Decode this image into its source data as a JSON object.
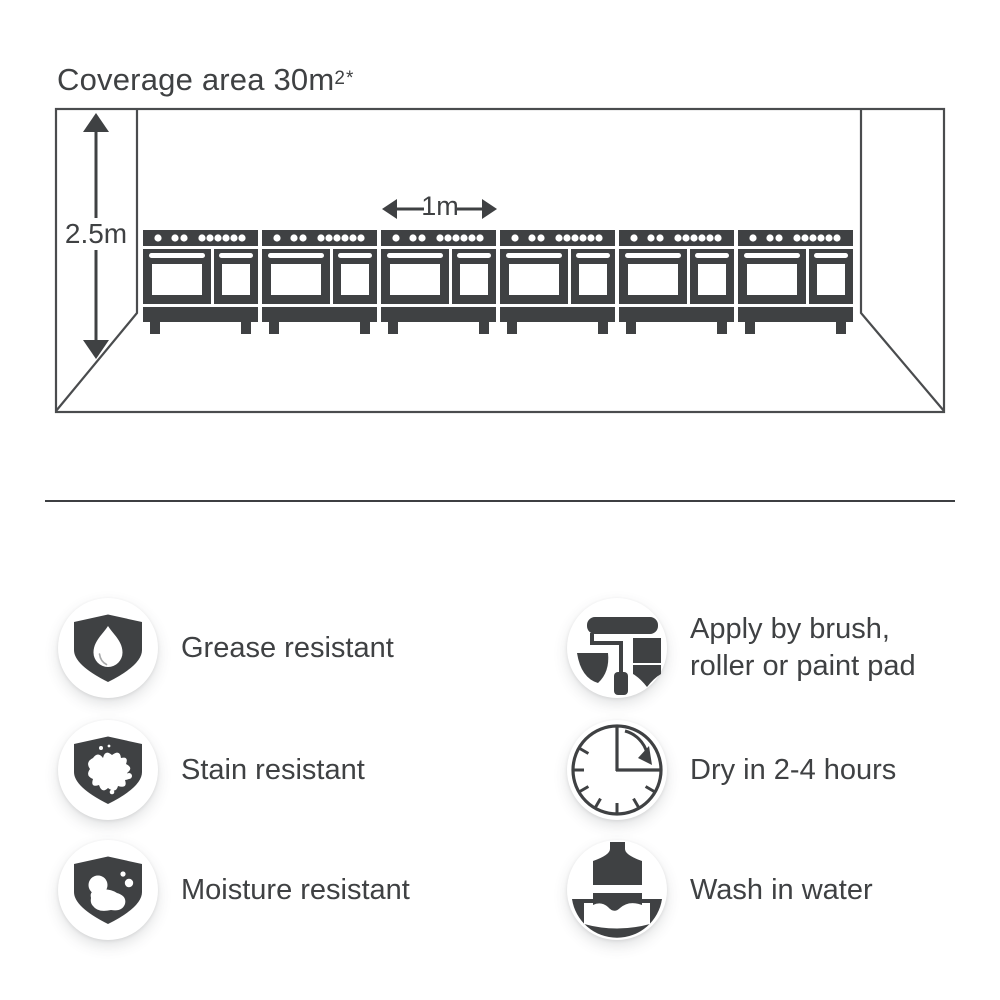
{
  "colors": {
    "ink": "#3f4143",
    "line": "#4a4c4e",
    "background": "#ffffff"
  },
  "coverage": {
    "title": "Coverage area 30m",
    "title_superscript": "2*",
    "height_label": "2.5m",
    "width_label": "1m",
    "stove_count": 6
  },
  "features": {
    "left": [
      {
        "icon": "shield-droplet-icon",
        "label": "Grease resistant"
      },
      {
        "icon": "shield-splat-icon",
        "label": "Stain resistant"
      },
      {
        "icon": "shield-bubbles-icon",
        "label": "Moisture resistant"
      }
    ],
    "right": [
      {
        "icon": "paint-roller-icon",
        "label_lines": [
          "Apply by brush,",
          "roller or paint pad"
        ]
      },
      {
        "icon": "clock-icon",
        "label_lines": [
          "Dry in 2-4 hours"
        ]
      },
      {
        "icon": "wash-brush-icon",
        "label_lines": [
          "Wash in water"
        ]
      }
    ]
  }
}
